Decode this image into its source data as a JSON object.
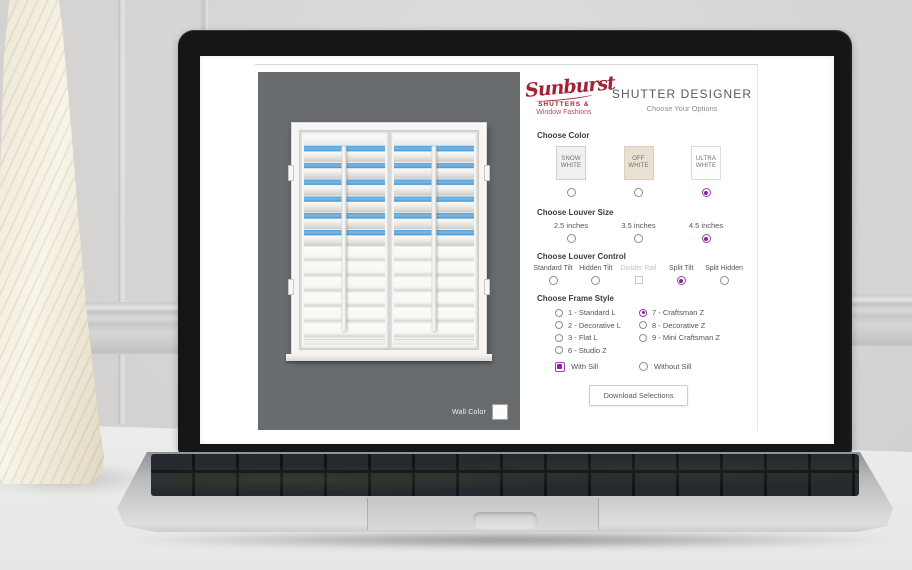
{
  "brand": {
    "script": "Sunburst",
    "line2": "SHUTTERS &",
    "line3": "Window Fashions",
    "color": "#a02236"
  },
  "header": {
    "title": "SHUTTER DESIGNER",
    "subtitle": "Choose Your Options"
  },
  "accent_color": "#a53ab5",
  "preview": {
    "wall_color_label": "Wall Color",
    "wall_background": "#686c6f",
    "sky_blue": "#58a5dc",
    "shutter_panels": 2,
    "open_louver_rows": 6,
    "closed_louver_rows": 6
  },
  "choose_color": {
    "label": "Choose Color",
    "options": [
      {
        "name": "SNOW WHITE",
        "swatch": "#f1f0ee",
        "selected": false
      },
      {
        "name": "OFF WHITE",
        "swatch": "#e8e1d1",
        "selected": false
      },
      {
        "name": "ULTRA WHITE",
        "swatch": "#fdfdfd",
        "selected": true
      }
    ]
  },
  "choose_louver_size": {
    "label": "Choose Louver Size",
    "options": [
      {
        "name": "2.5 inches",
        "selected": false
      },
      {
        "name": "3.5 inches",
        "selected": false
      },
      {
        "name": "4.5 inches",
        "selected": true
      }
    ]
  },
  "choose_louver_control": {
    "label": "Choose Louver Control",
    "options": [
      {
        "name": "Standard Tilt",
        "selected": false,
        "disabled": false
      },
      {
        "name": "Hidden Tilt",
        "selected": false,
        "disabled": false
      },
      {
        "name": "Divider Rail",
        "selected": false,
        "disabled": true
      },
      {
        "name": "Split Tilt",
        "selected": true,
        "disabled": false
      },
      {
        "name": "Split Hidden",
        "selected": false,
        "disabled": false
      }
    ]
  },
  "choose_frame_style": {
    "label": "Choose Frame Style",
    "col1": [
      {
        "name": "1 - Standard L",
        "selected": false
      },
      {
        "name": "2 - Decorative L",
        "selected": false
      },
      {
        "name": "3 - Flat L",
        "selected": false
      },
      {
        "name": "6 - Studio Z",
        "selected": false
      }
    ],
    "col2": [
      {
        "name": "7 - Craftsman Z",
        "selected": true
      },
      {
        "name": "8 - Decorative Z",
        "selected": false
      },
      {
        "name": "9 - Mini Craftsman Z",
        "selected": false
      }
    ]
  },
  "sill": {
    "with_sill": {
      "name": "With Sill",
      "selected": true
    },
    "without_sill": {
      "name": "Without Sill",
      "selected": false
    }
  },
  "download_button_label": "Download Selections"
}
